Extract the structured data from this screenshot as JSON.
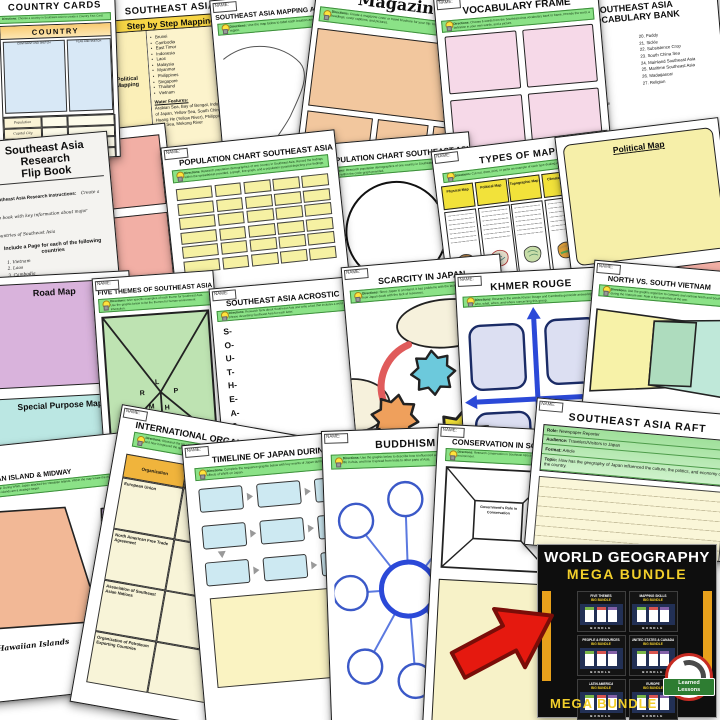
{
  "colors": {
    "directions_green": "#8BE287",
    "promo_yellow": "#F2CF2B",
    "promo_black": "#0E0E0E",
    "arrow_red": "#E5190F",
    "cell_yellow": "#F6F1A3",
    "header_orange": "#F0B43C"
  },
  "common": {
    "name_label": "NAME:",
    "directions_label": "Directions:"
  },
  "sheets": {
    "country_cards": {
      "title": "COUNTRY CARDS",
      "directions": "Choose a country in Southeast Asia to create a Country Fact Card.",
      "card_title": "COUNTRY",
      "sketch_left": "CONTINENT AND SKETCH",
      "sketch_right": "FLAG AND SKETCH",
      "rows": [
        "Population",
        "Capital City",
        "Language",
        "Major Exports"
      ]
    },
    "step_mapping": {
      "title": "SOUTHEAST ASIA",
      "banner": "Step by Step Mapping",
      "side1": "Political Mapping",
      "side2": "Physical Features",
      "countries": [
        "Brunei",
        "Cambodia",
        "East Timor",
        "Indonesia",
        "Laos",
        "Malaysia",
        "Myanmar",
        "Philippines",
        "Singapore",
        "Thailand",
        "Vietnam"
      ],
      "water_label": "Water Features:",
      "water_text": "Arabian Sea, Bay of Bengal, Indus River, Sea of Japan, Yellow Sea, South China Sea, Huang He (Yellow River), Philippine Sea, Java Sea, Mekong River"
    },
    "mapping_activity": {
      "title": "SOUTHEAST ASIA MAPPING ACTIVITY",
      "directions": "Use the map below to label each location and outline a region."
    },
    "magazine": {
      "title": "Magazine",
      "directions": "Create a magazine cover or travel brochure for your trip. Include a catchy title, main headings, cover captions, and pictures."
    },
    "vocabulary_frame": {
      "title": "VOCABULARY FRAME",
      "directions": "Choose 6 words from the Southeast Asia vocabulary bank to frame. Provide the word, a definition in your own words, and a picture."
    },
    "vocab_bank": {
      "title1": "SOUTHEAST ASIA",
      "title2": "VOCABULARY BANK",
      "left": [
        "1.  Archipelago",
        "2.  Cordillera",
        "3.  Endemic",
        "4.  Fauna",
        "5.  Flora",
        "6.  Insular",
        "7.  Batik",
        "8.  Buffer State",
        "9.  Longhouse",
        "10. Maritime",
        "11. Primate City",
        "12. Sphere of Influence",
        "13. Urbanisation",
        "14. Wat",
        "15. Association of"
      ],
      "right": [
        "20. Paddy",
        "21. Sickle",
        "22. Subsistence Crop",
        "23. South China Sea",
        "24. Mainland Southeast Asia",
        "25. Maritime Southeast Asia",
        "26. Madagascar",
        "27. Religion"
      ]
    },
    "flip_book": {
      "title_line1": "Southeast Asia",
      "title_line2": "Research",
      "title_line3": "Flip Book",
      "instructions_label": "Southeast Asia Research Instructions:",
      "instructions_text": "Create a flip book with key information about major countries of Southeast Asia",
      "include_label": "Include a Page for each of the following countries",
      "countries": [
        "1.  Vietnam",
        "2.  Laos",
        "3.  Cambodia",
        "4.  Thailand",
        "5.  Myanmar (Burma)",
        "6.  West Malaysia",
        "7.  Singapore"
      ]
    },
    "population_table": {
      "title": "POPULATION CHART SOUTHEAST ASIA",
      "directions": "Research population demographics of one country in Southeast Asia. Record the findings within the spreadsheet provided, a graph, line graph, and a population pyramid depicting your findings."
    },
    "population_pie": {
      "title": "POPULATION CHART SOUTHEAST ASIA",
      "directions": "Research population demographics of one country in Southeast Asia. Record the findings within the circle graph provided."
    },
    "types_of_maps": {
      "title": "TYPES OF MAPS",
      "directions": "Cut out, draw, print, or paste an example of each type dealing with Southeast Asia.",
      "headers": [
        "Physical Map",
        "Political Map",
        "Topographic Map",
        "Climate Map",
        "Road Map"
      ]
    },
    "map_examples_right": {
      "label1": "Political Map",
      "label2": "Topographic Map"
    },
    "map_examples_left": {
      "label1": "Road Map",
      "label2": "Special Purpose Map"
    },
    "five_themes": {
      "title": "FIVE THEMES OF SOUTHEAST ASIA",
      "directions": "Give specific examples of each theme for Southeast Asia. Use the graphic below to list the themes for human-environment interaction.",
      "letters": [
        "L",
        "R",
        "P",
        "M",
        "H"
      ]
    },
    "acrostic": {
      "title": "SOUTHEAST ASIA ACROSTIC",
      "directions": "Research facts about Southeast Asia and write a fact that includes a word or phrase describing Southeast Asia for each letter.",
      "letters": [
        "S-",
        "O-",
        "U-",
        "T-",
        "H-",
        "E-",
        "A-",
        "S-",
        "T-"
      ]
    },
    "scarcity": {
      "title": "SCARCITY IN JAPAN",
      "directions": "Since Japan is an island, it has problems with the lack of resources. Research how Japan deals with the lack of resources."
    },
    "khmer_rouge": {
      "title": "KHMER ROUGE",
      "directions": "Research the words Khmer Rouge and Cambodia genocide answering who, what, when, and where concerning this group."
    },
    "north_south": {
      "title": "NORTH VS. SOUTH VIETNAM",
      "directions": "Use the graphic organizer to compare and contrast North and South Vietnam during the Vietnam war. Note a few outcomes of the war."
    },
    "hawaiian": {
      "title": "HAWAIIAN ISLAND & MIDWAY",
      "directions": "During WWII, Japan attacked the Hawaiian Islands. Within the map locate the military airports and battle sites on those islands and explain why these islands are a strategic target.",
      "hand_label": "Mid",
      "bottom_label": "Hawaiian Islands"
    },
    "international": {
      "title": "INTERNATIONAL ORGANIZATIONS",
      "directions": "Research the list of international organizations, report the member countries, and how it improved the quality of life for its members.",
      "headers": [
        "Organization",
        "Member Countries"
      ],
      "orgs": [
        "European Union",
        "North American Free Trade Agreement",
        "Association of Southeast Asian Nations",
        "Organization of Petroleum Exporting Countries"
      ]
    },
    "timeline": {
      "title": "TIMELINE OF JAPAN DURING WWII",
      "directions": "Complete the sequence graphic below with key events of Japan during WWII. Write a summary of the effects of WWII on Japan."
    },
    "buddhism": {
      "title": "BUDDHISM",
      "directions": "Use the graphic below to describe how it influenced art in Asia, how it influenced life in Asia, and how it spread from India to other parts of Asia."
    },
    "conservation": {
      "title": "CONSERVATION IN SOUTHEAST ASIA",
      "directions": "Research conservation in Southeast Asia and how the government helps protect the environment.",
      "frame_label": "Government's Role in Conservation"
    },
    "raft": {
      "title": "SOUTHEAST ASIA RAFT",
      "fields": [
        {
          "label": "Role:",
          "value": "Newspaper Reporter"
        },
        {
          "label": "Audience:",
          "value": "Travelers/Visitors to Japan"
        },
        {
          "label": "Format:",
          "value": "Article"
        },
        {
          "label": "Topic:",
          "value": "How has the geography of Japan influenced the culture, the politics, and economy of the country."
        }
      ]
    }
  },
  "promo": {
    "heading": "WORLD GEOGRAPHY",
    "subheading": "MEGA BUNDLE",
    "footer": "MEGA BUNDLE",
    "thumb_footer": "BUNDLE",
    "thumbs": [
      {
        "l1": "FIVE THEMES",
        "l2": "BIG BUNDLE"
      },
      {
        "l1": "MAPPING SKILLS",
        "l2": "BIG BUNDLE"
      },
      {
        "l1": "PEOPLE & RESOURCES",
        "l2": "BIG BUNDLE"
      },
      {
        "l1": "UNITED STATES & CANADA",
        "l2": "BIG BUNDLE"
      },
      {
        "l1": "LATIN AMERICA",
        "l2": "BIG BUNDLE"
      },
      {
        "l1": "EUROPE",
        "l2": "BIG BUNDLE"
      }
    ],
    "logo_line1": "Learned",
    "logo_line2": "Lessons"
  }
}
